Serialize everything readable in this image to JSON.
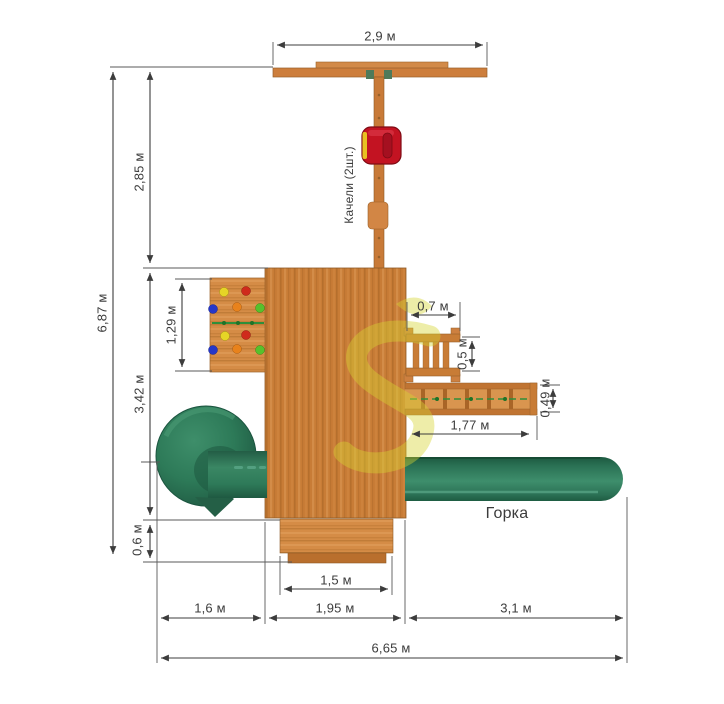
{
  "diagram": {
    "kind": "playground-top-view-dimension-drawing",
    "units": "м"
  },
  "annotations": {
    "swings": "Качели (2шт.)",
    "slide": "Горка"
  },
  "dimensions": {
    "beam_width": "2,9 м",
    "overall_depth": "6,87 м",
    "swing_bay_depth": "2,85 м",
    "platform_bay_depth": "3,42 м",
    "steps_depth": "0,6 м",
    "climbing_wall_width": "1,29 м",
    "ladder_width": "0,7 м",
    "ladder_depth": "0,5 м",
    "bridge_depth": "0,49 м",
    "bridge_length": "1,77 м",
    "steps_width": "1,5 м",
    "left_bay_width": "1,6 м",
    "platform_width": "1,95 м",
    "slide_bay_width": "3,1 м",
    "overall_width": "6,65 м"
  },
  "colors": {
    "background": "#ffffff",
    "wood": "#c87c36",
    "wood_light": "#d8954e",
    "slide_green": "#2e7c5e",
    "swing_red": "#c31322",
    "swing_yellow": "#e8c222",
    "rope_green": "#2f8f3a",
    "watermark_yellow": "#d6d532",
    "dimension_line": "#3c3c3c",
    "climbing_hold_colors": [
      "#e6d426",
      "#cf2a1c",
      "#2637c8",
      "#e8821c",
      "#57c12c"
    ]
  }
}
